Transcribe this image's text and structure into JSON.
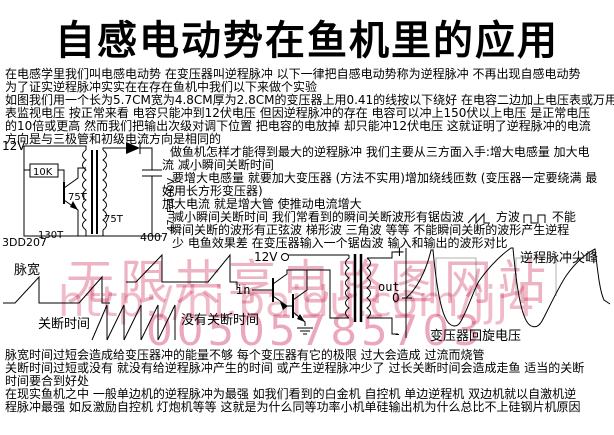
{
  "title": "自感电动势在鱼机里的应用",
  "intro": {
    "lines": [
      "在电感学里我们叫电感电动势 在变压器叫逆程脉冲 以下一律把自感电动势称为逆程脉冲 不再出现自感电动势",
      "为了证实逆程脉冲实实在在存在鱼机中我们以下来做个实验",
      "如图我们用一个长为5.7CM宽为4.8CM厚为2.8CM的变压器上用0.41的线按以下绕好 在电容二边加上电压表或万用",
      "表监视电压 按正常来看 电容只能冲到12伏电压 但因逆程脉冲的存在 电容可以冲上150伏以上电压 是正常电压",
      "的10倍或更高 然而我们把输出次级对调下位置 把电容的电放掉 却只能冲12伏电压 这就证明了逆程脉冲的电流",
      "方向是与三极管和初级电流方向是相同的"
    ]
  },
  "right": {
    "l1": "做鱼机怎样才能得到最大的逆程脉冲 我们主要从三方面入手:增大电感量 加大电",
    "l2": "流 减小瞬间关断时间",
    "l3": "要增大电感量 就要加大变压器 (方法不实用)增加绕线匝数 (变压器一定要绕满 最",
    "l4": "好用长方形变压器)",
    "l5": "加大电流 就是增大管 使推动电流增大",
    "l6a": "减小瞬间关断时间 我们常看到的瞬间关断波形有锯齿波",
    "l6b": "方波",
    "l6c": "不能",
    "l7": "瞬间关断的波形有正弦波 梯形波  三角波 等等  不能瞬间关断的波形产生逆程",
    "l8": "少 电鱼效果差 在变压器输入一个锯齿波 输入和输出的波形对比"
  },
  "circuit": {
    "supply": "12V",
    "resistor": "10K",
    "winding_upper": "75T",
    "winding_lower": "75T",
    "winding_feedback": "130T",
    "transistor": "3DD207",
    "diode": "4007",
    "capacitor": "47uF/400V"
  },
  "waveforms": {
    "pulse_width": "脉宽",
    "off_time": "关断时间",
    "no_off_time": "没有关断时间",
    "supply": "12V",
    "input": "in",
    "output": "out",
    "plus": "+",
    "zero": "0",
    "minus": "-",
    "spike": "逆程脉冲尖峰",
    "flyback": "变压器回旋电压"
  },
  "bottom": {
    "lines": [
      "脉宽时间过短会造成给变压器冲的能量不够 每个变压器有它的极限 过大会造成 过流而烧管",
      "关断时间过短或没有 就没有给逆程脉冲产生的时间 或产生逆程脉冲少了 过长关断时间会造成走鱼 适当的关断",
      "时间要合到好处",
      "在现实鱼机之中 一般单边机的逆程脉冲为最强 如我们看到的白金机 自控机 单边逆程机 双边机就以自激机逆",
      "程脉冲最强 如反激励自控机 灯炮机等等 这就是为什么同等功率小机单硅输出机为什么总比不上硅钢片机原因"
    ]
  },
  "watermark": {
    "main": "无限共享电路图网站",
    "url": "http://hi.baidu.com/jjj4",
    "number": "00505785703",
    "color": "#edb3c2"
  },
  "colors": {
    "ink": "#000000",
    "background": "#ffffff",
    "reference_gray": "#b0b0b0"
  }
}
